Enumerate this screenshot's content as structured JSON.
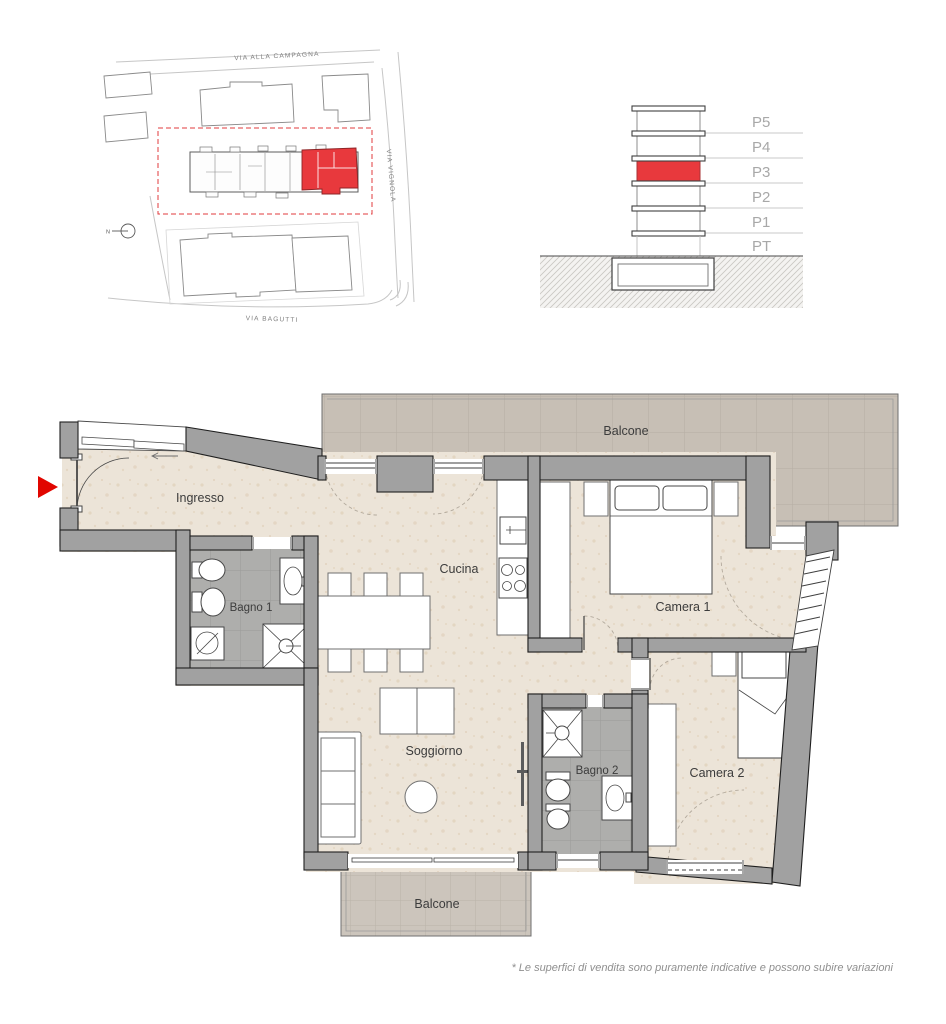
{
  "site_plan": {
    "streets": [
      {
        "name": "VIA ALLA CAMPAGNA"
      },
      {
        "name": "VIA VIGNOLA"
      },
      {
        "name": "VIA BAGUTTI"
      }
    ],
    "north_symbol": "N"
  },
  "elevation": {
    "floors": [
      {
        "label": "P5",
        "highlighted": false
      },
      {
        "label": "P4",
        "highlighted": false
      },
      {
        "label": "P3",
        "highlighted": true
      },
      {
        "label": "P2",
        "highlighted": false
      },
      {
        "label": "P1",
        "highlighted": false
      },
      {
        "label": "PT",
        "highlighted": false
      }
    ]
  },
  "floor_plan": {
    "rooms": [
      {
        "id": "balcone-top",
        "label": "Balcone"
      },
      {
        "id": "ingresso",
        "label": "Ingresso"
      },
      {
        "id": "bagno-1",
        "label": "Bagno 1"
      },
      {
        "id": "cucina",
        "label": "Cucina"
      },
      {
        "id": "camera-1",
        "label": "Camera 1"
      },
      {
        "id": "soggiorno",
        "label": "Soggiorno"
      },
      {
        "id": "bagno-2",
        "label": "Bagno 2"
      },
      {
        "id": "camera-2",
        "label": "Camera 2"
      },
      {
        "id": "balcone-bottom",
        "label": "Balcone"
      }
    ]
  },
  "footer": {
    "disclaimer": "* Le superfici di vendita sono puramente indicative e possono subire variazioni"
  },
  "colors": {
    "highlight_red": "#e8393d",
    "entrance_arrow_red": "#e10600",
    "wall_gray": "#a1a1a1",
    "floor_beige": "#ece4d8",
    "bathroom_tile": "#aeaeac",
    "balcony_tile": "#c7bfb5"
  }
}
